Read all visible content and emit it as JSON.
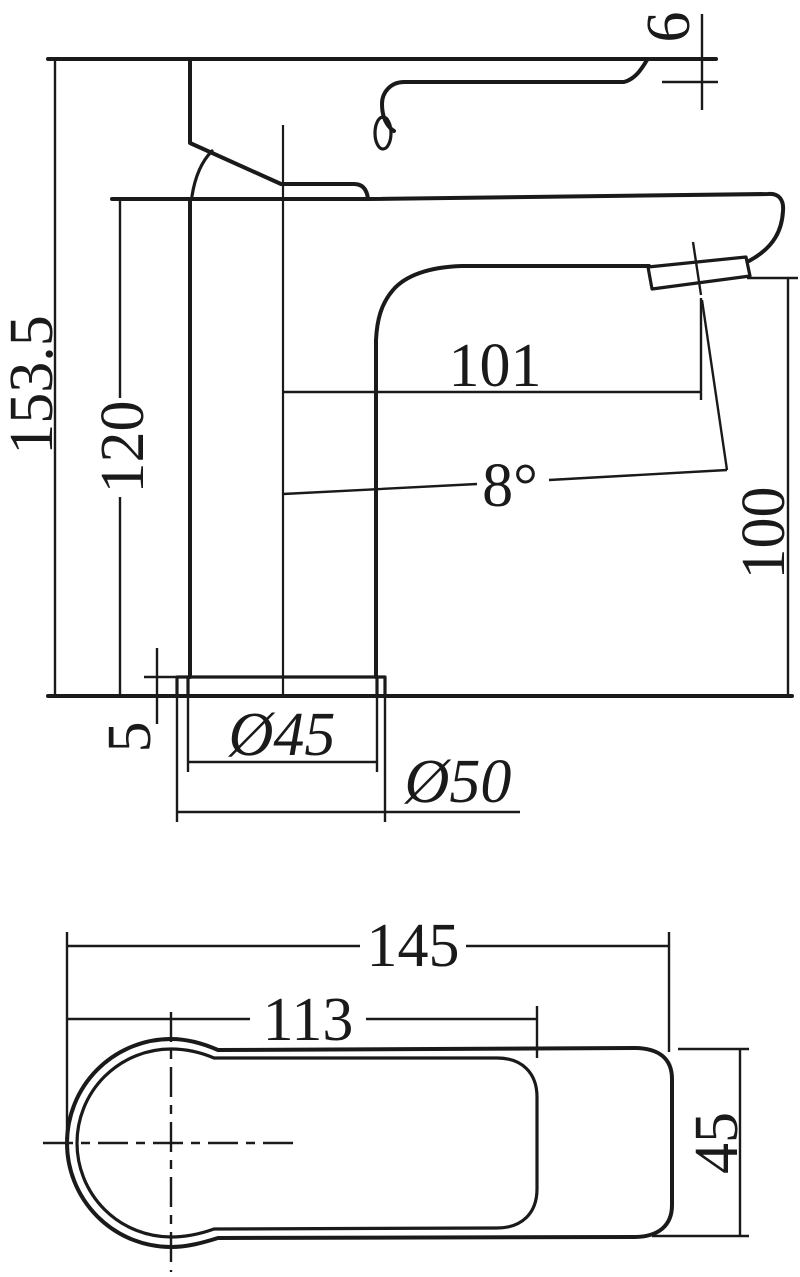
{
  "drawing": {
    "subject": "Basin mixer tap - dimensioned technical drawing",
    "line_color": "#1a1a1a",
    "background_color": "#ffffff",
    "side_view": {
      "name": "side elevation",
      "dims": {
        "overall_height": "153.5",
        "body_height": "120",
        "lever_tip_thickness": "6",
        "spout_reach": "101",
        "spout_angle": "8°",
        "spout_outlet_height": "100",
        "base_plate_thickness": "5",
        "base_inner_diameter": "Ø45",
        "base_outer_diameter": "Ø50"
      }
    },
    "top_view": {
      "name": "plan view",
      "dims": {
        "overall_length": "145",
        "body_length": "113",
        "body_width": "45"
      }
    }
  }
}
